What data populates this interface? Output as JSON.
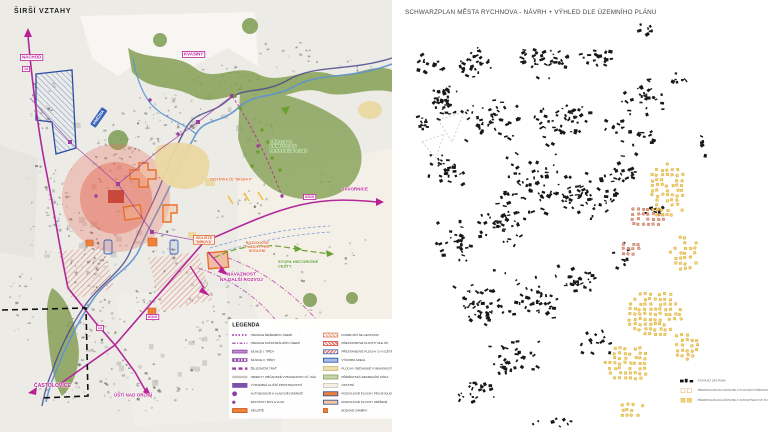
{
  "left_map": {
    "title": "ŠIRŠÍ VZTAHY",
    "labels": {
      "nachod": "NÁCHOD",
      "kvasiny": "KVASINY",
      "knezna": "KNĚŽNA",
      "javornice": "JAVORNICE",
      "castolovice": "ČASTOLOVICE",
      "usti": "ÚSTÍ NAD ORLICÍ",
      "pristup": "PŘÍSTUP K PŘÍMĚSTSKÉ\nREKREAČNÍ ZÓNĚ",
      "zastavka": "ZASTÁVKA ŽD \"ŠKODA II\"",
      "sidliste": "SÍDLIŠTĚ\n\"MÍROVÁ\"",
      "rozvoj": "ROZVOJOVÉ\nPLOCHY PRO\nBYDLENÍ",
      "stopa": "STOPA HISTORICKÉ CESTY",
      "navaznost": "NÁVAZNOST\nNA DALŠÍ ROZVOJ"
    },
    "badges": {
      "b14_north": "14",
      "b14_south": "14",
      "b319_east": "II/319",
      "b319_south": "II/319"
    },
    "legend": {
      "title": "LEGENDA",
      "left_items": [
        {
          "swatch": "sw-dots",
          "label": "HRANICE ŘEŠENÉHO ÚZEMÍ"
        },
        {
          "swatch": "sw-dashdot",
          "label": "HRANICE KATASTRÁLNÍHO ÚZEMÍ"
        },
        {
          "swatch": "sw-band",
          "label": "SILNICE I. TŘÍDY"
        },
        {
          "swatch": "sw-hatchband",
          "label": "SILNICE II. TŘÍDY"
        },
        {
          "swatch": "sw-dashband",
          "label": "ŽELEZNIČNÍ TRAŤ"
        },
        {
          "swatch": "sw-grayline",
          "label": "OBJEKTY OBČANSKÉ VYBAVENOSTI VČ. ZÁZ."
        },
        {
          "swatch": "sw-wideband",
          "label": "VÝZNAMNÁ ULIČNÍ PROSTRANSTVÍ"
        },
        {
          "swatch": "sw-node",
          "label": "AUTOBUSOVÉ A VLAKOVÉ NÁDRAŽÍ"
        },
        {
          "swatch": "sw-node-sm",
          "label": "ZASTÁVKY BUS A VLAK"
        },
        {
          "swatch": "sw-orangebox",
          "label": "SÍDLIŠTĚ"
        }
      ],
      "right_items": [
        {
          "swatch": "sw-salmonhatch",
          "label": "FORMUJÍCÍ SE CENTRUM"
        },
        {
          "swatch": "sw-redhatch",
          "label": "PŘESTAVBOVÉ PLOCHY DLE ÚP"
        },
        {
          "swatch": "sw-redhatch2",
          "label": "PŘESTAVBOVÉ PLOCHY S VYUŽITÍM PRO BYDLENÍ"
        },
        {
          "swatch": "sw-bluebox",
          "label": "VÝROBNÍ AREÁL"
        },
        {
          "swatch": "sw-creambox",
          "label": "PLOCHY OBČANSKÉ VYBAVENOSTI"
        },
        {
          "swatch": "sw-greenbox",
          "label": "PŘÍMĚSTSKÁ REKREAČNÍ ZÓNA"
        },
        {
          "swatch": "sw-palebox",
          "label": "OSTATNÍ"
        },
        {
          "swatch": "sw-orangeblue",
          "label": "ROZVOJOVÉ PLOCHY PRO BYDLENÍ"
        },
        {
          "swatch": "sw-peachblue",
          "label": "ROZVOJOVÉ PLOCHY SMÍŠENÉ"
        },
        {
          "swatch": "sw-orangesq",
          "label": "BODOVÉ ZÁMĚRY"
        }
      ]
    }
  },
  "right_map": {
    "title": "SCHWARZPLAN MĚSTA RYCHNOVA - NÁVRH + VÝHLED DLE ÚZEMNÍHO PLÁNU",
    "legend": {
      "items": [
        {
          "swatch": "ssw-black",
          "label": "STÁVAJÍCÍ ZÁSTAVBA"
        },
        {
          "swatch": "ssw-orout",
          "label": "PŘEDPOKLÁDANÁ ZÁSTAVBA V PLOCHÁCH PŘESTAVBY DLE ÚP"
        },
        {
          "swatch": "ssw-yel",
          "label": "PŘEDPOKLÁDANÁ ZÁSTAVBA V ZASTAVITELNÝCH PLOCHÁCH DLE ÚP"
        }
      ]
    }
  },
  "colors": {
    "road_magenta": "#bb1f96",
    "route_purple": "#8a3fa0",
    "green": "#6aa030",
    "orange": "#e8702a",
    "red_core": "#d84a3a",
    "blue": "#3a63b8",
    "river_blue": "#5b93cf",
    "planned_yellow": "#f4d27a",
    "planned_salmon": "#e5a68c",
    "building_black": "#181818"
  }
}
